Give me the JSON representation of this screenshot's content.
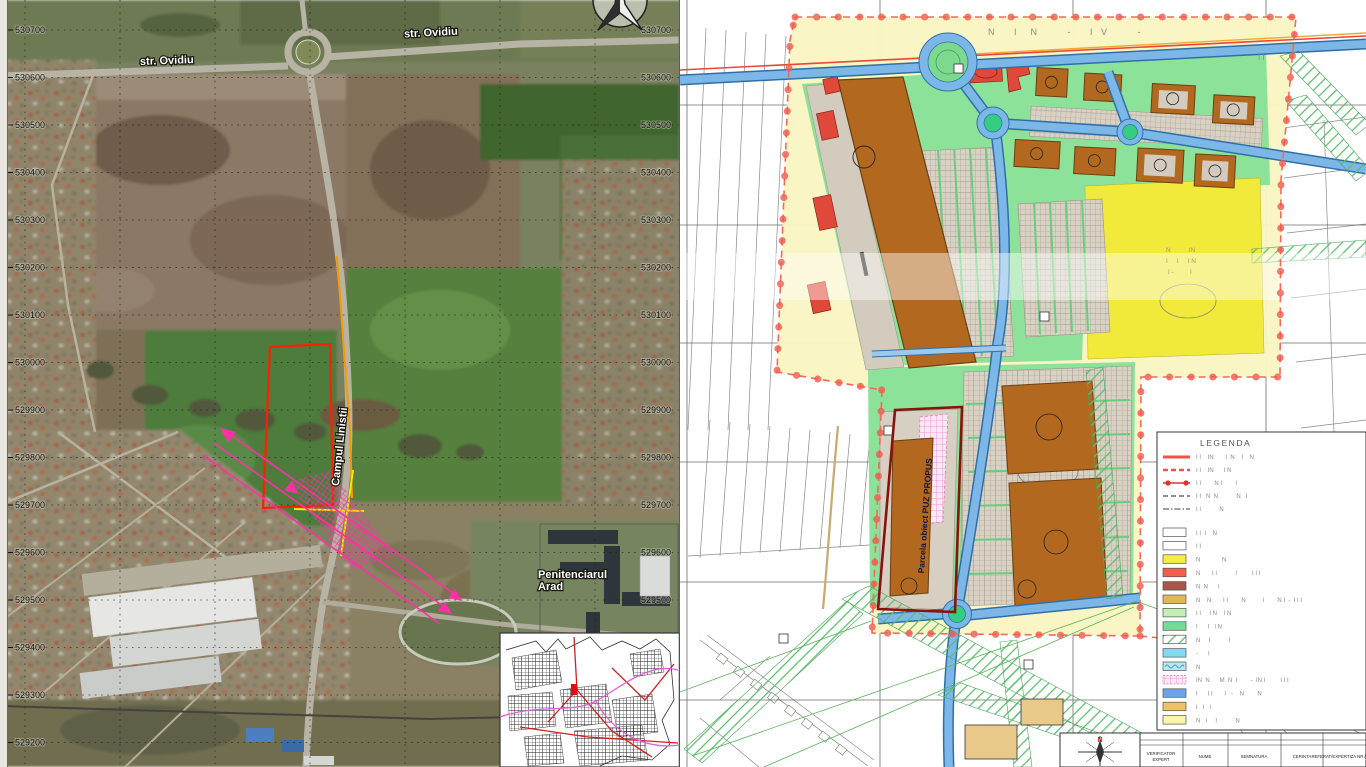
{
  "left_map": {
    "coordinate_labels": [
      "530700",
      "530600",
      "530500",
      "530400",
      "530300",
      "530200",
      "530100",
      "530000",
      "529900",
      "529800",
      "529700",
      "529600",
      "529500",
      "529400",
      "529300",
      "529200"
    ],
    "street_label_1": "str. Ovidiu",
    "street_label_2": "str. Ovidiu",
    "road_label": "Campul Linistii",
    "poi_label_line1": "Penitenciarul",
    "poi_label_line2": "Arad"
  },
  "right_map": {
    "parcel_label": "Parcela obiect PUZ PROPUS",
    "top_faint_text": "N   I  N     -   I V     -",
    "side_faint_text": "I I",
    "yellow_zone_lines": [
      "N          IN",
      "I     I     I N",
      "I -         I"
    ],
    "legend": {
      "title": "LEGENDA",
      "line_items": [
        {
          "symbol": "red-solid",
          "label": "I I    IN       I  N    I    N"
        },
        {
          "symbol": "red-dashed",
          "label": "I I    IN      I N"
        },
        {
          "symbol": "red-dot-line",
          "label": "I I        N I        I"
        },
        {
          "symbol": "grey-dashed",
          "label": "I I   N  N           N   I"
        },
        {
          "symbol": "grey-dashdot",
          "label": "I I           N"
        }
      ],
      "area_items": [
        {
          "swatch": "white",
          "label": "I I  I    N"
        },
        {
          "swatch": "white",
          "label": "I I"
        },
        {
          "swatch": "yellow",
          "label": "N             N"
        },
        {
          "swatch": "salmon",
          "label": "N       I I           I         I I I"
        },
        {
          "swatch": "dark-red",
          "label": "N  N      I"
        },
        {
          "swatch": "ochre",
          "label": "N    N       I I        N          I        N I  -  I I I"
        },
        {
          "swatch": "pale-green",
          "label": "I I     I N    I N"
        },
        {
          "swatch": "green",
          "label": "I      I   I N"
        },
        {
          "swatch": "green-hatch",
          "label": "N     I           I"
        },
        {
          "swatch": "light-blue",
          "label": "-      I"
        },
        {
          "swatch": "wave-blue",
          "label": "N"
        },
        {
          "swatch": "pink-grid",
          "label": "IN  N      M  N  I        -  IN I         I I I"
        },
        {
          "swatch": "blue",
          "label": "I      I I       I   -    N        N"
        },
        {
          "swatch": "orange",
          "label": "I   I   I"
        },
        {
          "swatch": "pale-yellow",
          "label": "N   I     I           N"
        }
      ]
    },
    "title_block": {
      "north_letter": "N",
      "col1a": "VERIFICATOR",
      "col1b": "EXPERT",
      "col2": "NUME",
      "col3": "SEMNATURA",
      "col4": "CERINTA",
      "col5": "REFERAT/EXPERTIZA NR./DATA"
    }
  },
  "colors": {
    "boundary_red": "#f15a4e",
    "parcel_dark_red": "#8a120c",
    "site_outline_red": "#ff1f00",
    "magenta": "#ff2fa8",
    "bright_yellow": "#f2ea3a",
    "pale_yellow": "#faf5c2",
    "plan_green": "#8de29a",
    "road_blue": "#7cb7e8",
    "building_brown": "#b2691f",
    "building_red": "#e0493a"
  }
}
